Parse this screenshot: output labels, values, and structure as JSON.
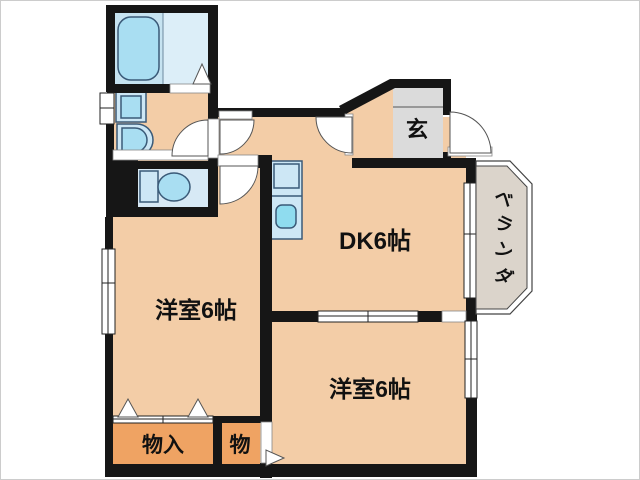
{
  "title": "apartment-floorplan",
  "rooms": {
    "dk": {
      "label": "DK6帖"
    },
    "bedroom_left": {
      "label": "洋室6帖"
    },
    "bedroom_right": {
      "label": "洋室6帖"
    },
    "entrance": {
      "label": "玄"
    },
    "storage_main": {
      "label": "物入"
    },
    "storage_small": {
      "label": "物"
    },
    "veranda_chars": [
      "ベ",
      "ラ",
      "ン",
      "ダ"
    ]
  },
  "colors": {
    "background": "#FFFFFF",
    "wall": "#161616",
    "floor": "#F3CDA7",
    "closet": "#EFA363",
    "toilet_floor": "#D7E9F5",
    "bath_floor_left": "#C6E3F1",
    "bath_floor_right": "#DCEEF8",
    "fixture": "#CDE7F5",
    "fixture_inner": "#A9DEF2",
    "sink": "#8FDCEF",
    "genkan": "#DBDBDB",
    "veranda": "#DBD4CB",
    "opening": "#FFFFFF"
  }
}
